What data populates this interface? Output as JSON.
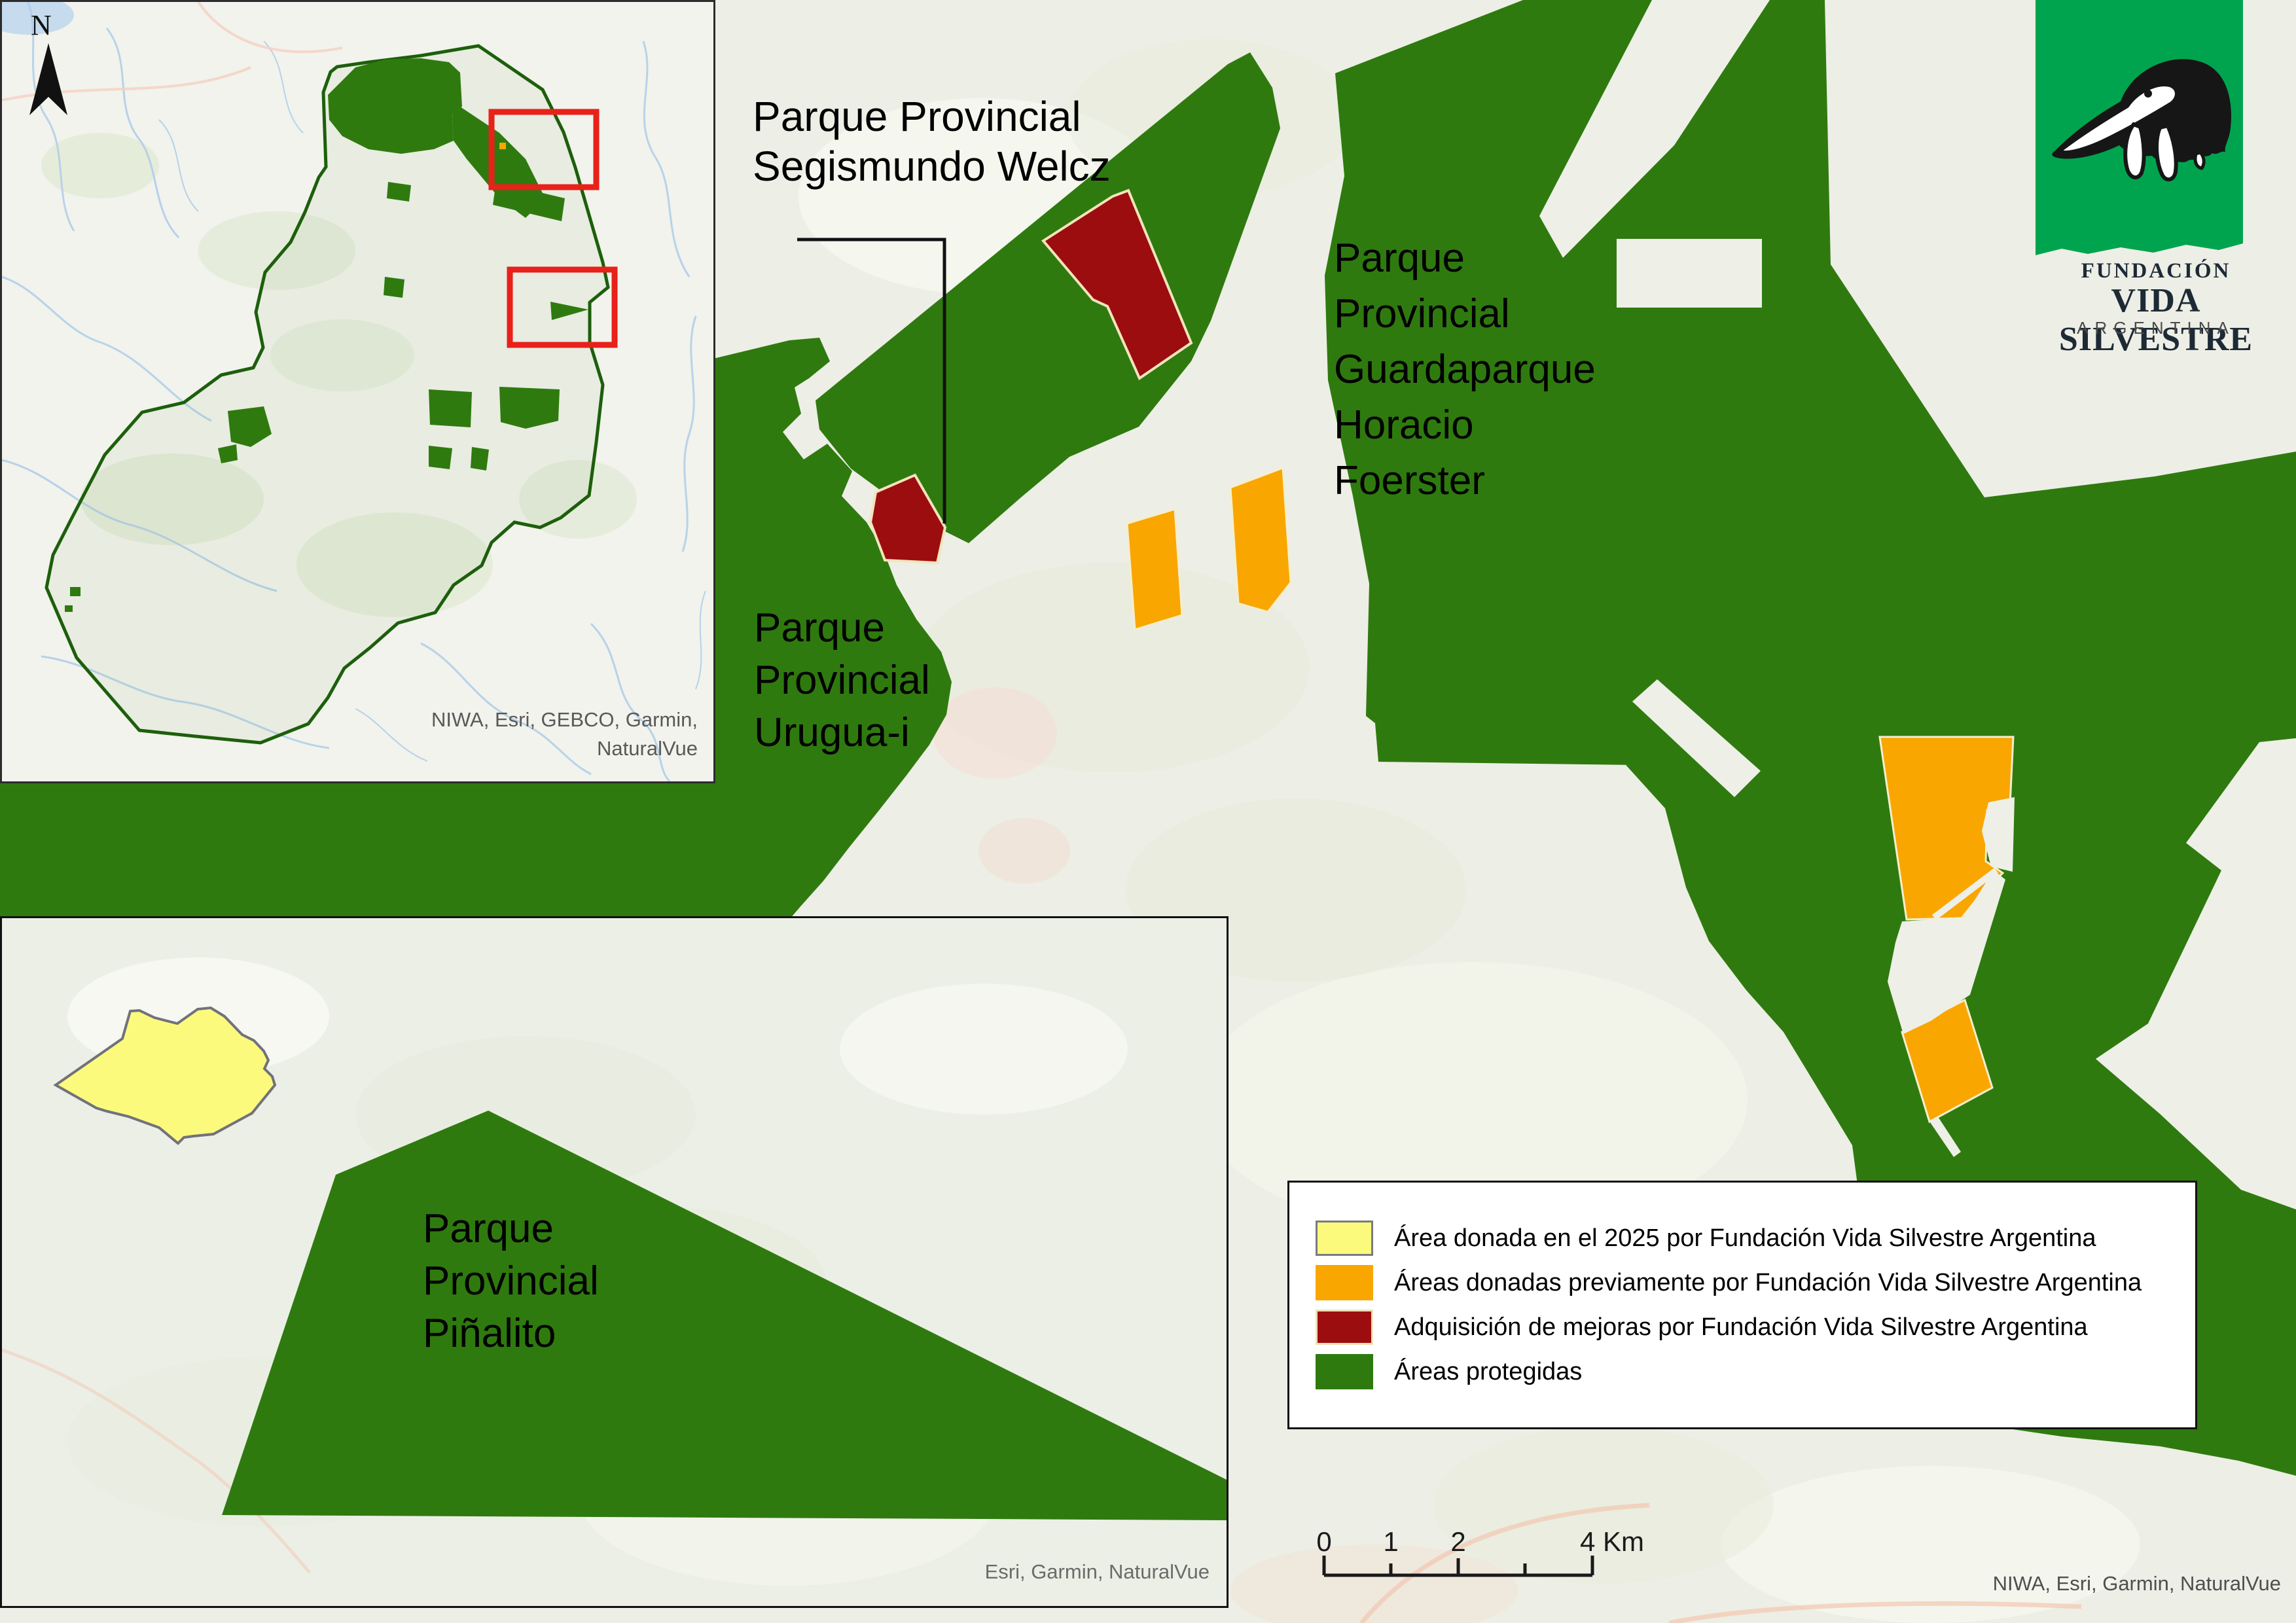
{
  "colors": {
    "protected_green": "#2f7a0f",
    "donated_2025_yellow": "#fbfa7d",
    "donated_prev_orange": "#f9a600",
    "mejoras_red": "#9c0d10",
    "basemap": "#edeee5",
    "logo_green": "#00a44f",
    "inset_highlight_red": "#e8211a",
    "river_blue": "#aeccea"
  },
  "inset_overview": {
    "north_label": "N",
    "attribution": [
      "NIWA, Esri, GEBCO, Garmin,",
      "NaturalVue"
    ]
  },
  "inset_pinalito": {
    "park_label": [
      "Parque",
      "Provincial",
      "Piñalito"
    ],
    "attribution": "Esri, Garmin, NaturalVue"
  },
  "main_map": {
    "labels": {
      "welcz": [
        "Parque Provincial",
        "Segismundo Welcz"
      ],
      "foerster": [
        "Parque",
        "Provincial",
        "Guardaparque",
        "Horacio",
        "Foerster"
      ],
      "uruguai": [
        "Parque",
        "Provincial",
        "Urugua-i"
      ]
    },
    "attribution": "NIWA, Esri, Garmin, NaturalVue"
  },
  "legend": {
    "items": [
      {
        "label": "Área donada en el 2025 por Fundación Vida Silvestre Argentina",
        "color": "#fbfa7d"
      },
      {
        "label": "Áreas donadas previamente por Fundación Vida Silvestre Argentina",
        "color": "#f9a600"
      },
      {
        "label": "Adquisición de mejoras por Fundación Vida Silvestre Argentina",
        "color": "#9c0d10"
      },
      {
        "label": "Áreas protegidas",
        "color": "#2f7a0f"
      }
    ]
  },
  "scale_bar": {
    "labels": [
      "0",
      "1",
      "2",
      "4 Km"
    ],
    "units": "Km"
  },
  "logo": {
    "line1": "FUNDACIÓN",
    "line2": "VIDA SILVESTRE",
    "line3": "ARGENTINA"
  }
}
